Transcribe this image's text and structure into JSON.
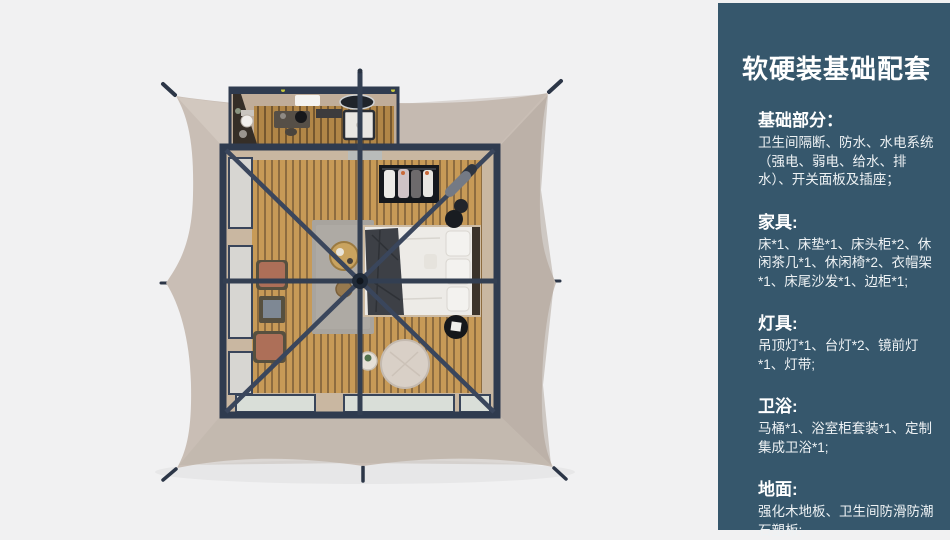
{
  "panel": {
    "title": "软硬装基础配套",
    "sections": [
      {
        "heading": "基础部分：",
        "body": "卫生间隔断、防水、水电系统（强电、弱电、给水、排水）、开关面板及插座；"
      },
      {
        "heading": "家具:",
        "body": "床*1、床垫*1、床头柜*2、休闲茶几*1、休闲椅*2、衣帽架*1、床尾沙发*1、边柜*1;"
      },
      {
        "heading": "灯具:",
        "body": "吊顶灯*1、台灯*2、镜前灯*1、灯带;"
      },
      {
        "heading": "卫浴:",
        "body": "马桶*1、浴室柜套装*1、定制集成卫浴*1;"
      },
      {
        "heading": "地面:",
        "body": "强化木地板、卫生间防滑防潮石塑板;"
      }
    ]
  },
  "illustration": {
    "colors": {
      "background": "#f1f1f2",
      "canvas": "#c9beb5",
      "canvas_shade_right": "#b0a59d",
      "frame": "#2f3b4f",
      "wood_floor": "#c79a57",
      "rug": "#a8a49e",
      "bedding": "#edebe7",
      "chair_leather": "#ad6f58",
      "panel_background": "#36576c",
      "panel_text": "#f2f5f7"
    }
  }
}
